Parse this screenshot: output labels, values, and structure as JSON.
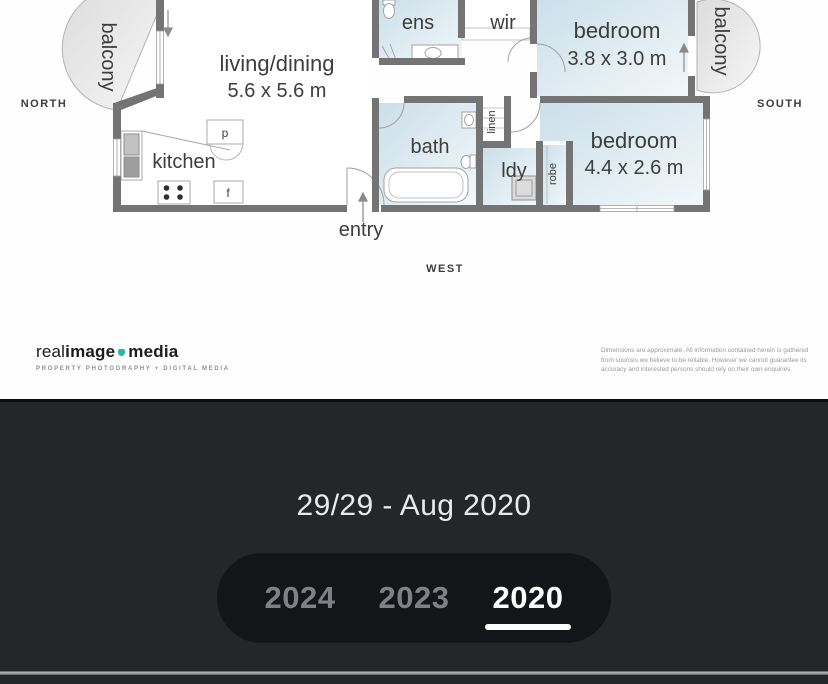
{
  "floorplan": {
    "rooms": {
      "living": {
        "name": "living/dining",
        "dims": "5.6 x 5.6 m"
      },
      "kitchen": {
        "name": "kitchen"
      },
      "ens": {
        "name": "ens"
      },
      "wir": {
        "name": "wir"
      },
      "bath": {
        "name": "bath"
      },
      "linen": {
        "name": "linen"
      },
      "laundry": {
        "name": "ldy"
      },
      "robe": {
        "name": "robe"
      },
      "bedroom_east": {
        "name": "bedroom",
        "dims": "3.8 x 3.0 m"
      },
      "bedroom_southeast": {
        "name": "bedroom",
        "dims": "4.4 x 2.6 m"
      },
      "balcony_north": {
        "name": "balcony"
      },
      "balcony_south": {
        "name": "balcony"
      },
      "pantry_abbrev": "p",
      "fridge_abbrev": "f"
    },
    "compass": {
      "north": "NORTH",
      "south": "SOUTH",
      "west": "WEST"
    },
    "entry": "entry",
    "branding": {
      "logo_part1": "real",
      "logo_part2": "image",
      "logo_part3": "media",
      "tagline": "PROPERTY PHOTOGRAPHY + DIGITAL MEDIA",
      "accent": "#2fb4ad"
    },
    "disclaimer": [
      "Dimensions are approximate.  All information contained herein is gathered",
      "from sources we believe to be reliable.  However we cannot guarantee its",
      "accuracy and interested persons should rely on their own enquiries."
    ]
  },
  "viewer": {
    "photo_counter": "29/29 - Aug 2020",
    "years": [
      {
        "label": "2024",
        "active": false
      },
      {
        "label": "2023",
        "active": false
      },
      {
        "label": "2020",
        "active": true
      }
    ],
    "colors": {
      "panel_bg": "#252629",
      "pill_bg": "#141518",
      "year_inactive": "#7e8186",
      "year_active": "#ffffff",
      "counter_text": "#e9eaed",
      "wall": "#747474",
      "room_tint": "#cde0eb"
    }
  }
}
